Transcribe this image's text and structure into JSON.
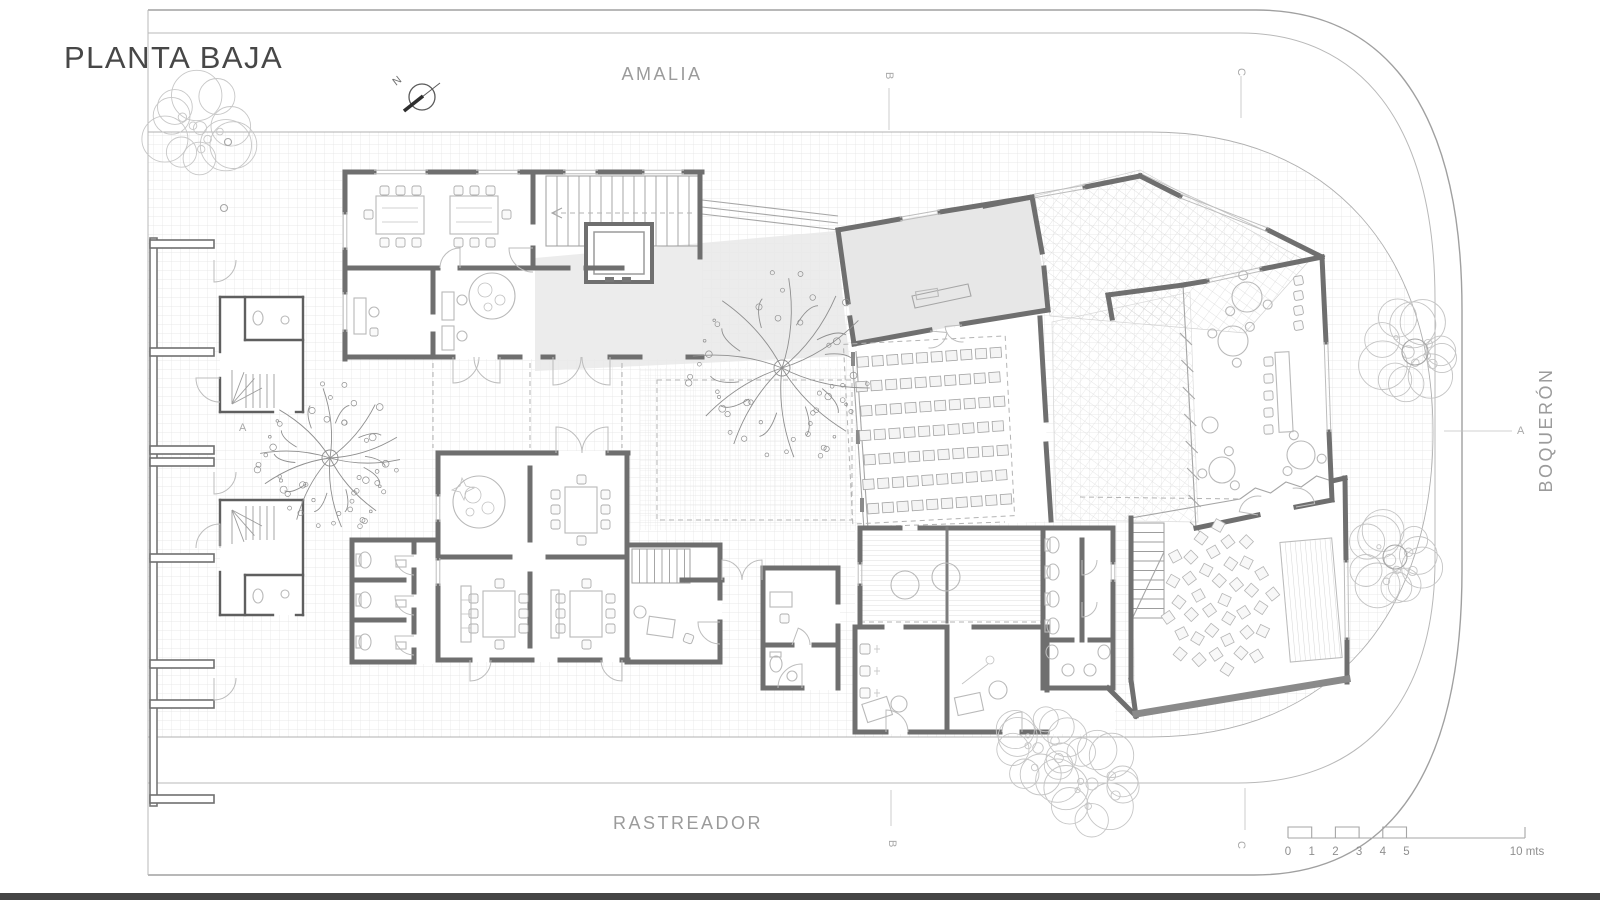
{
  "title": "PLANTA BAJA",
  "streets": {
    "top": "AMALIA",
    "bottom": "RASTREADOR",
    "right": "BOQUERÓN"
  },
  "north_label": "N",
  "section_markers": {
    "a": "A",
    "b": "B",
    "c": "C"
  },
  "scale_bar": {
    "ticks": [
      "0",
      "1",
      "2",
      "3",
      "4",
      "5"
    ],
    "end_label": "10 mts"
  },
  "colors": {
    "ink": "#6f6f6f",
    "light_ink": "#a6a6a6",
    "grid": "#e3e3e3",
    "floor_tint": "#e9e9e9",
    "street_text": "#9b9b9b",
    "title_text": "#474747"
  }
}
